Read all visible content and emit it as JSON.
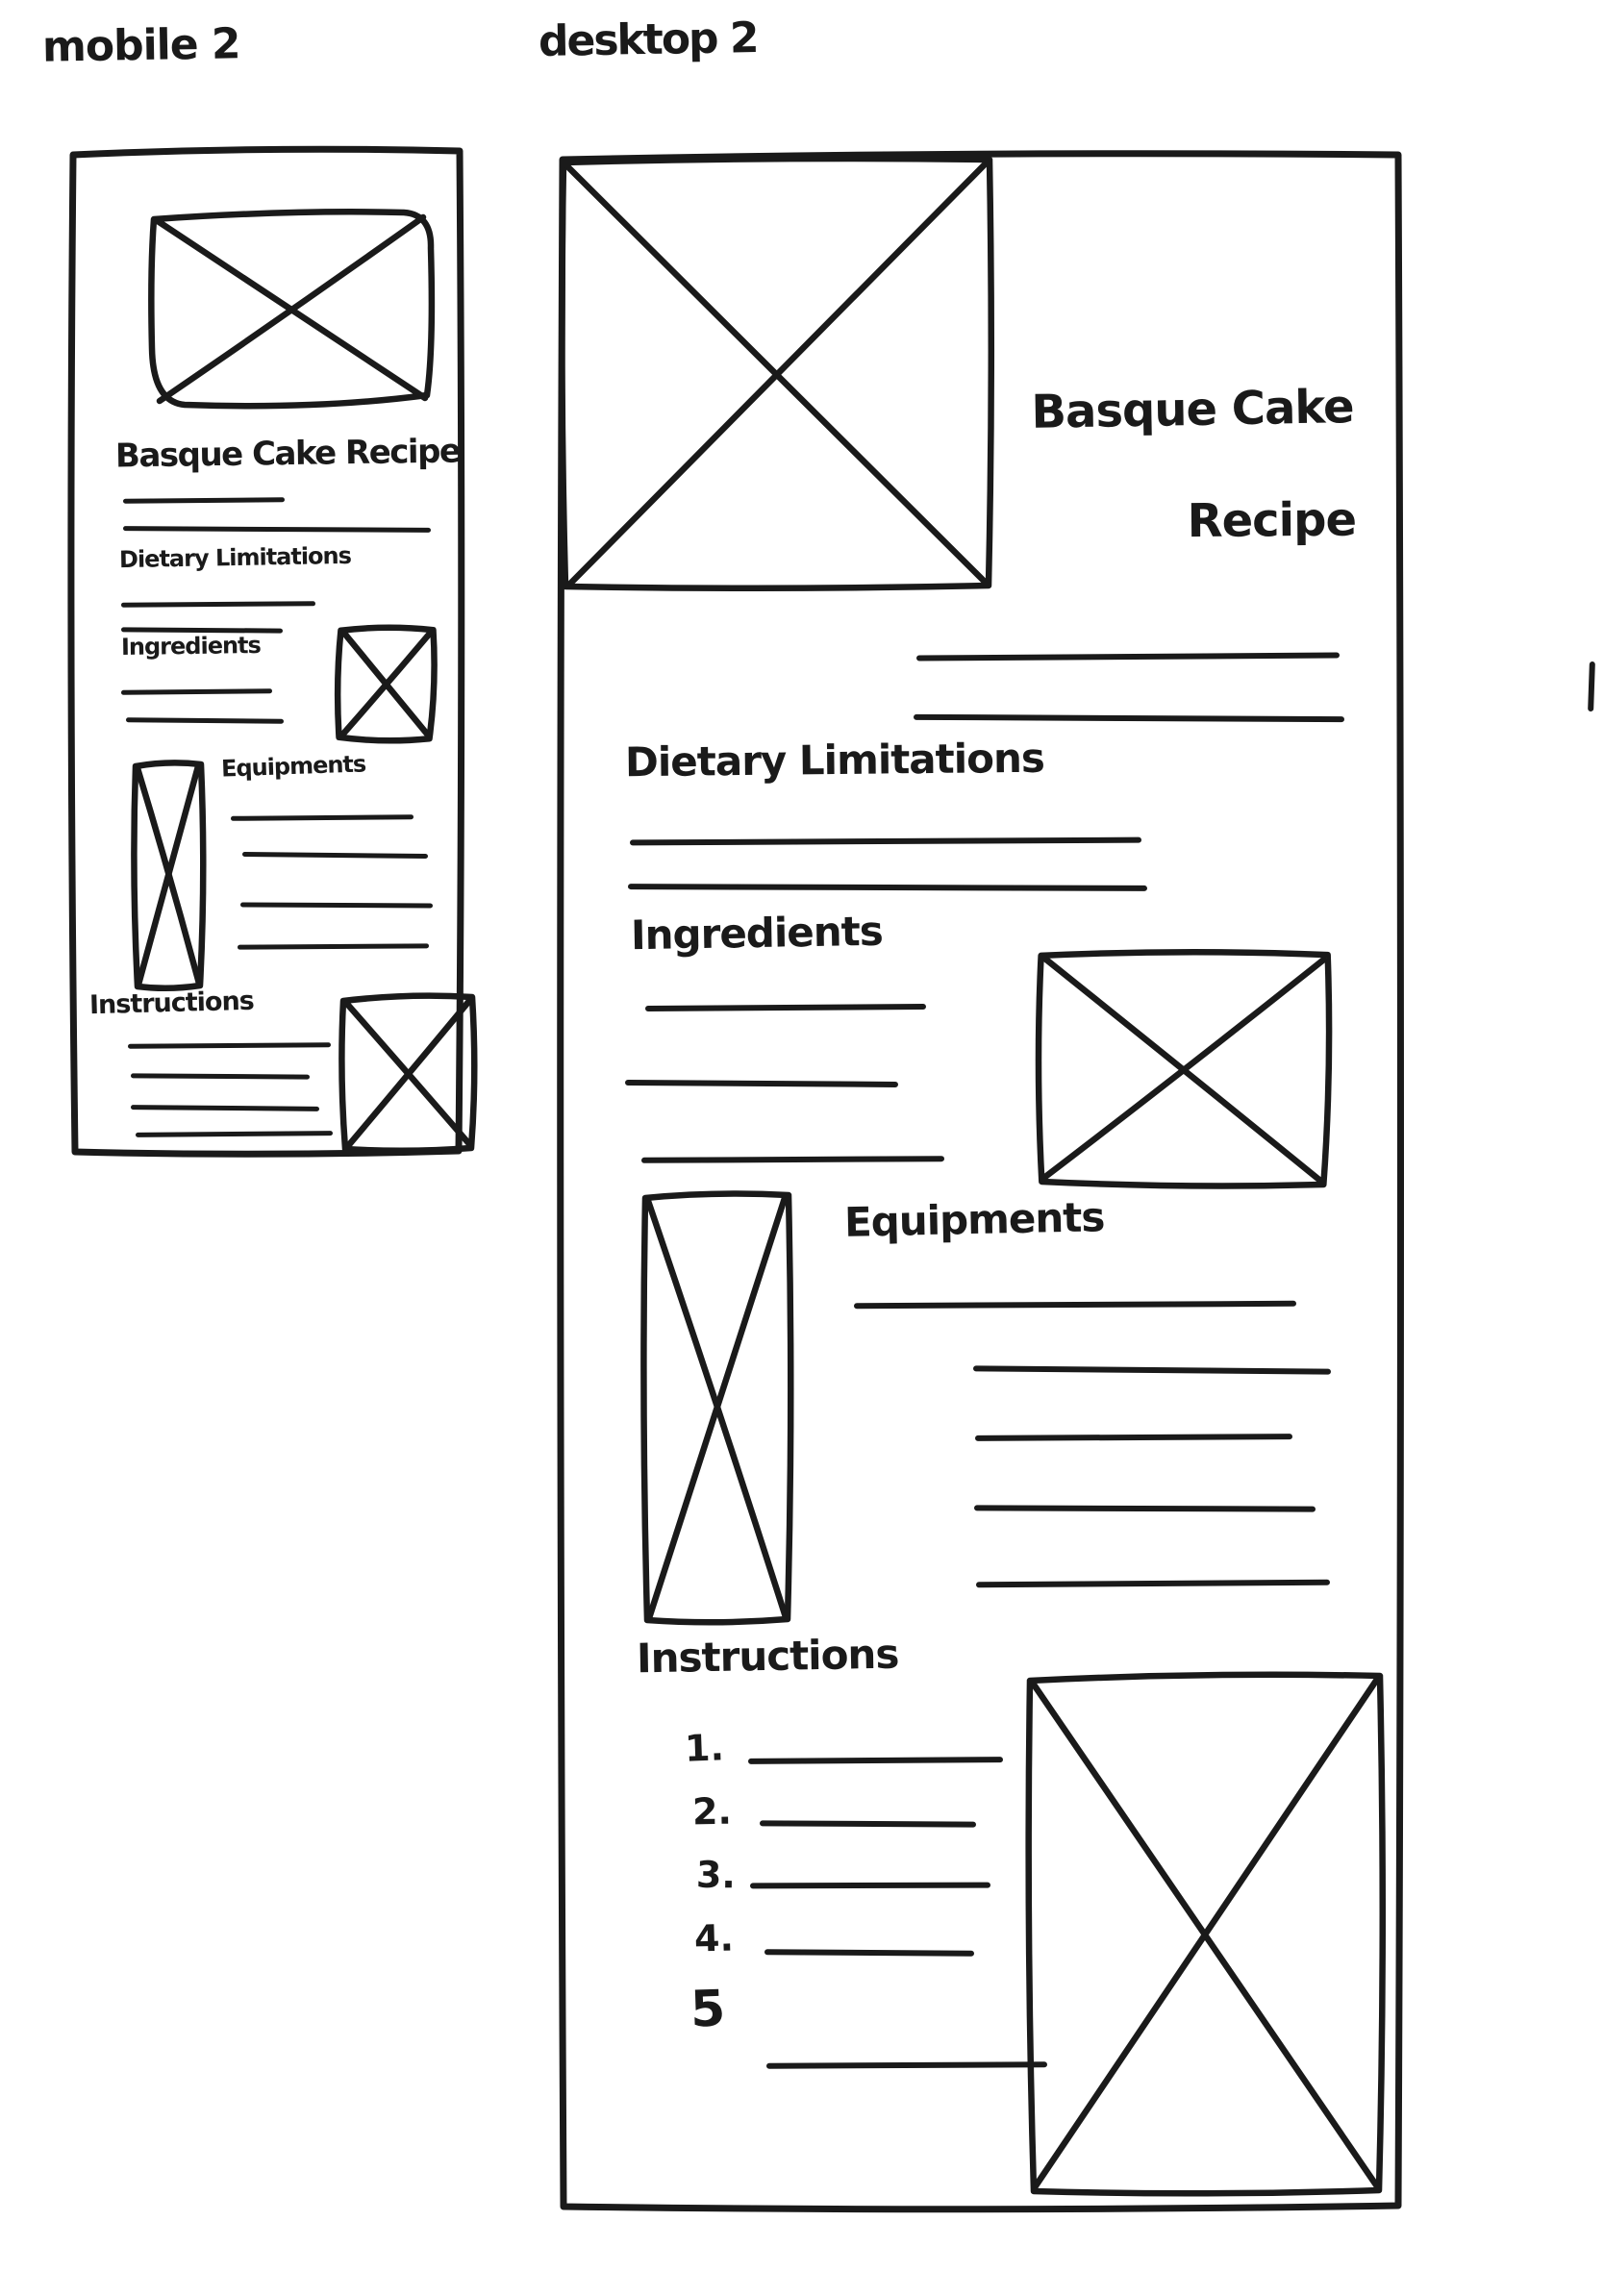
{
  "canvas": {
    "background": "#ffffff",
    "ink": "#1a1a1a"
  },
  "mobile": {
    "label": "mobile 2",
    "title": "Basque Cake Recipe",
    "sections": {
      "dietary": "Dietary Limitations",
      "ingredients": "Ingredients",
      "equipments": "Equipments",
      "instructions": "Instructions"
    }
  },
  "desktop": {
    "label": "desktop 2",
    "title_line1": "Basque Cake",
    "title_line2": "Recipe",
    "sections": {
      "dietary": "Dietary Limitations",
      "ingredients": "Ingredients",
      "equipments": "Equipments",
      "instructions": "Instructions"
    },
    "instructions_list": [
      "1.",
      "2.",
      "3.",
      "4.",
      "5"
    ]
  }
}
